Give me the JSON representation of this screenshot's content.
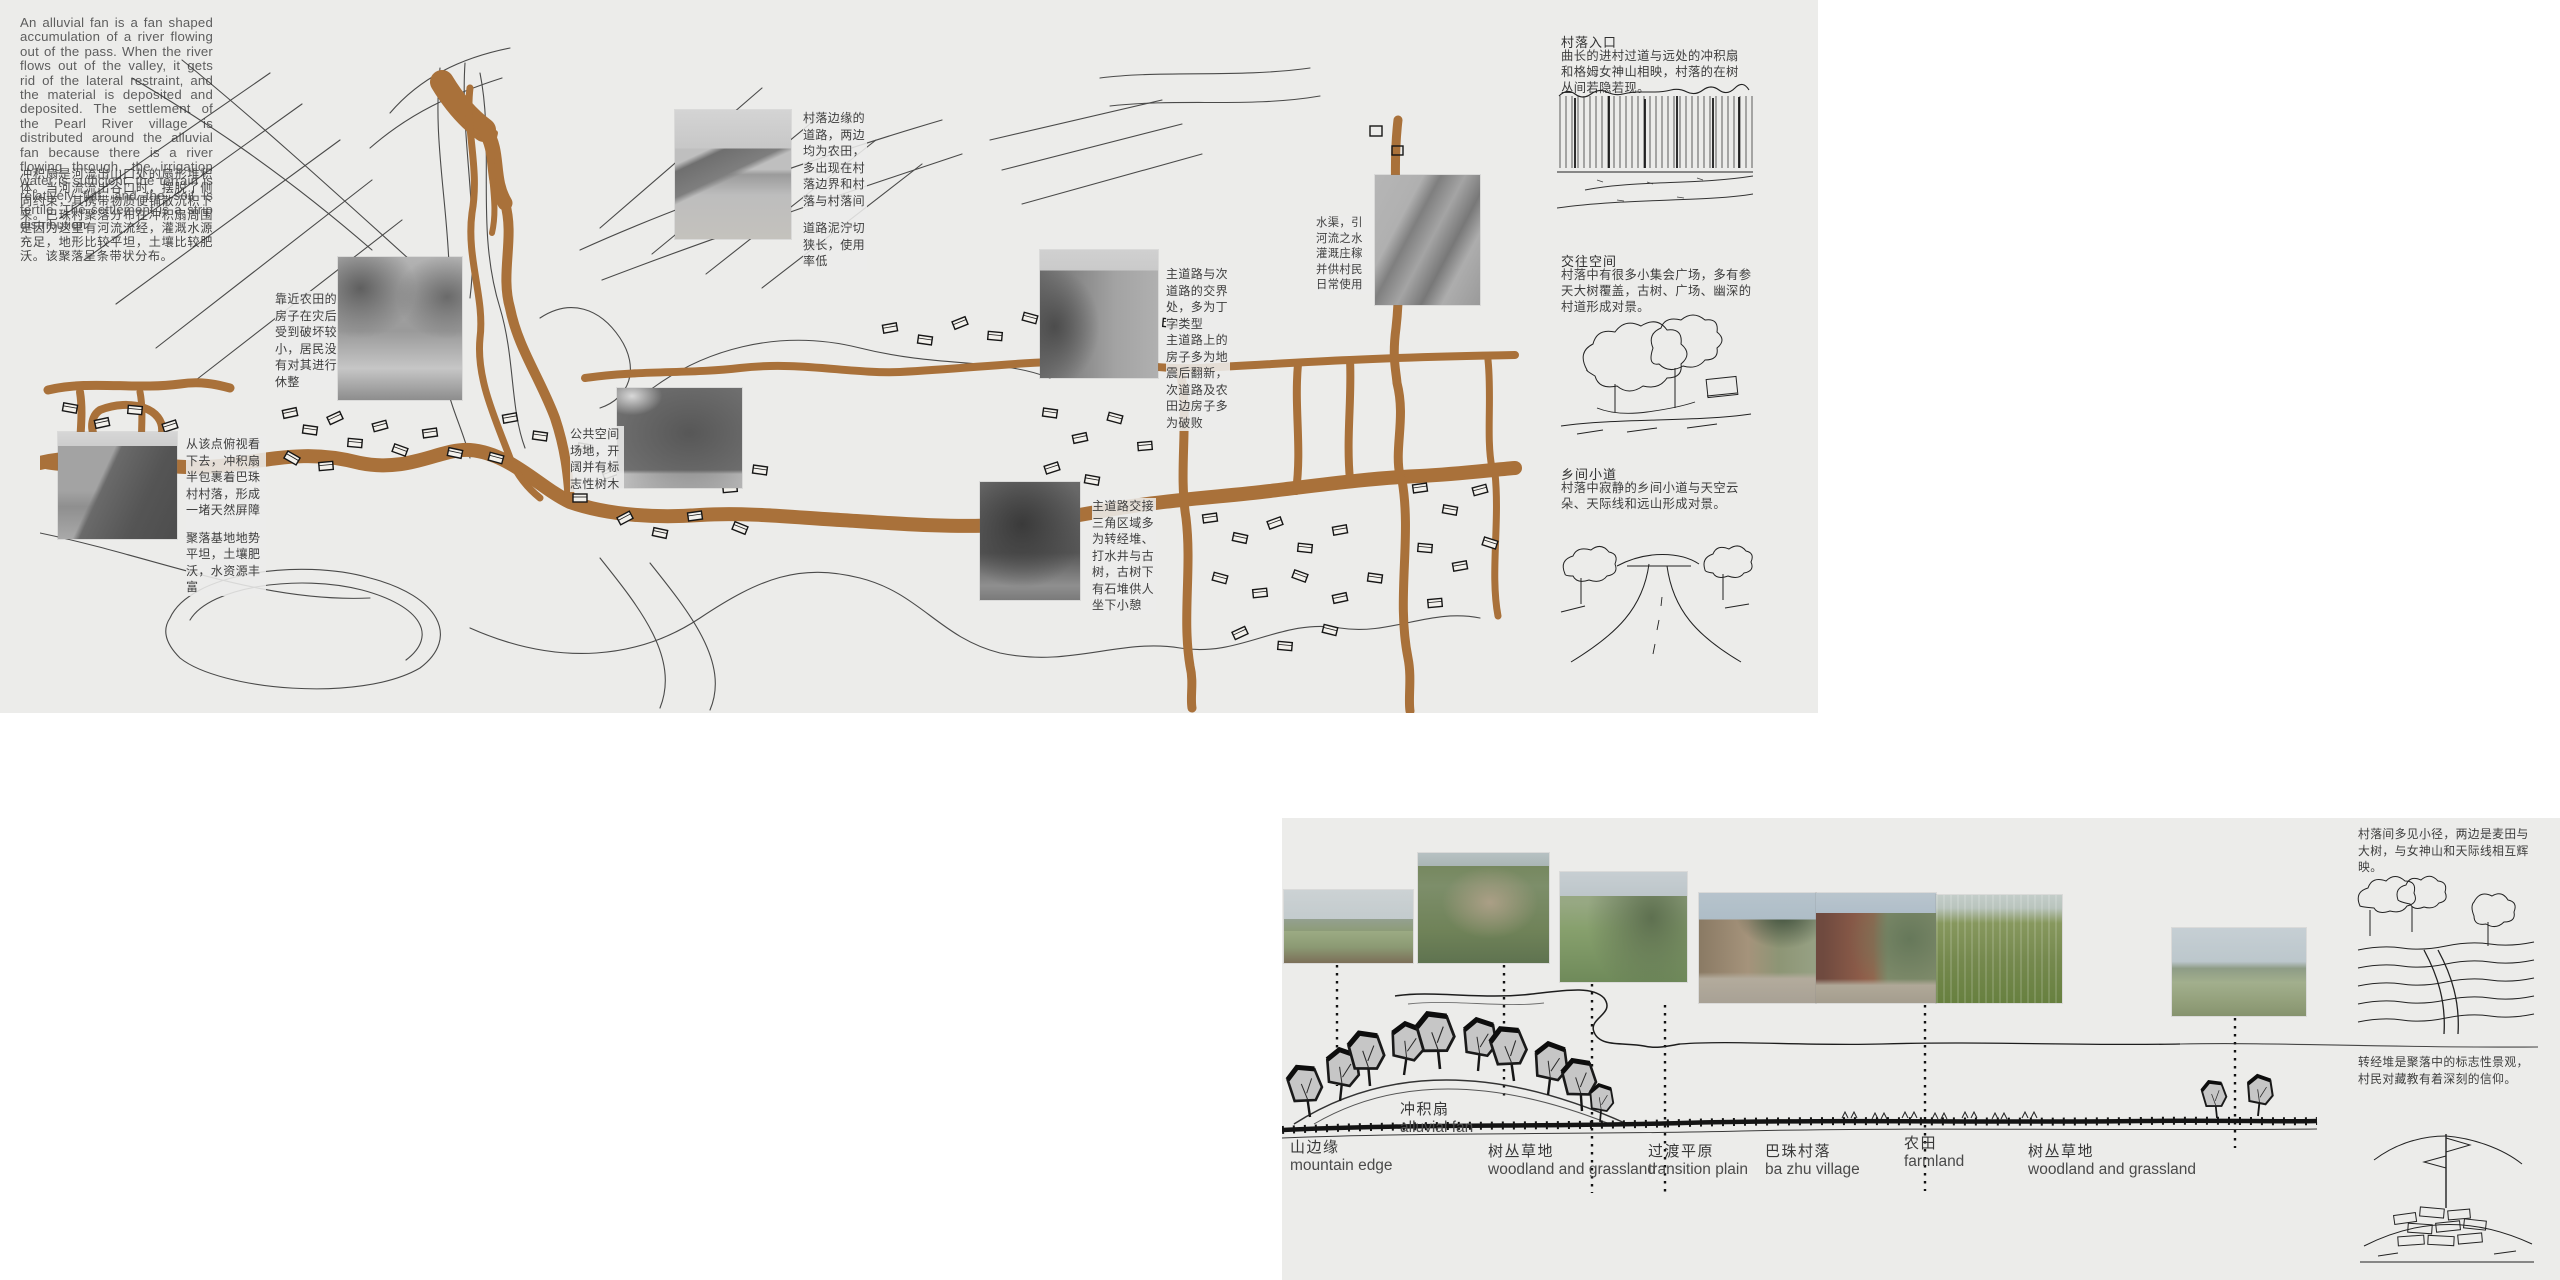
{
  "colors": {
    "panel": "#ececea",
    "road": "#a9713a",
    "ink": "#2b2b2b"
  },
  "intro": {
    "en": "An alluvial fan is a fan shaped accumulation of a river flowing out of the pass. When the river flows out of the valley, it gets rid of the lateral restraint, and the material is deposited and deposited. The settlement of the Pearl River village is distributed around the alluvial fan because there is a river flowing through, the irrigation water is sufficient, the terrain is relatively flat, and the soil is fertile. The settlement is a strip distribution.",
    "cn": "冲积扇是河流出山口处的扇形堆积体。当河流流出谷口时，摆脱了侧向约束，其携带物质便铺散沉积下来。巴珠村聚落分布在冲积扇周围是因为这里有河流流经，灌溉水源充足，地形比较平坦，土壤比较肥沃。该聚落呈条带状分布。"
  },
  "map": {
    "annotations": {
      "viewpoint_p1": "从该点俯视看下去，冲积扇半包裹着巴珠村村落，形成一堵天然屏障",
      "viewpoint_p2": "聚落基地地势平坦，土壤肥沃，水资源丰富",
      "near_farmland": "靠近农田的房子在灾后受到破坏较小，居民没有对其进行休整",
      "edge_road_p1": "村落边缘的道路，两边均为农田，多出现在村落边界和村落与村落间",
      "edge_road_p2": "道路泥泞切狭长，使用率低",
      "canal": "水渠，引河流之水灌溉庄稼并供村民日常使用",
      "junction_p1": "主道路与次道路的交界处，多为丁字类型",
      "junction_p2": "主道路上的房子多为地震后翻新，次道路及农田边房子多为破败",
      "public_space": "公共空间场地，开阔并有标志性树木",
      "triangle": "主道路交接三角区域多为转经堆、打水井与古树，古树下有石堆供人坐下小憩"
    }
  },
  "gallery": [
    {
      "title": "村落入口",
      "body": "曲长的进村过道与远处的冲积扇和格姆女神山相映，村落的在树丛间若隐若现。"
    },
    {
      "title": "交往空间",
      "body": "村落中有很多小集会广场，多有参天大树覆盖，古树、广场、幽深的村道形成对景。"
    },
    {
      "title": "乡间小道",
      "body": "村落中寂静的乡间小道与天空云朵、天际线和远山形成对景。"
    }
  ],
  "section": {
    "labels": [
      {
        "cn": "山边缘",
        "en": "mountain edge"
      },
      {
        "cn": "冲积扇",
        "en": "alluvial fan"
      },
      {
        "cn": "树丛草地",
        "en": "woodland and grassland"
      },
      {
        "cn": "过渡平原",
        "en": "transition plain"
      },
      {
        "cn": "巴珠村落",
        "en": "ba zhu village"
      },
      {
        "cn": "农田",
        "en": "farmland"
      },
      {
        "cn": "树丛草地",
        "en": "woodland and grassland"
      }
    ],
    "notes": [
      "村落间多见小径，两边是麦田与大树，与女神山和天际线相互辉映。",
      "转经堆是聚落中的标志性景观，村民对藏教有着深刻的信仰。"
    ]
  }
}
